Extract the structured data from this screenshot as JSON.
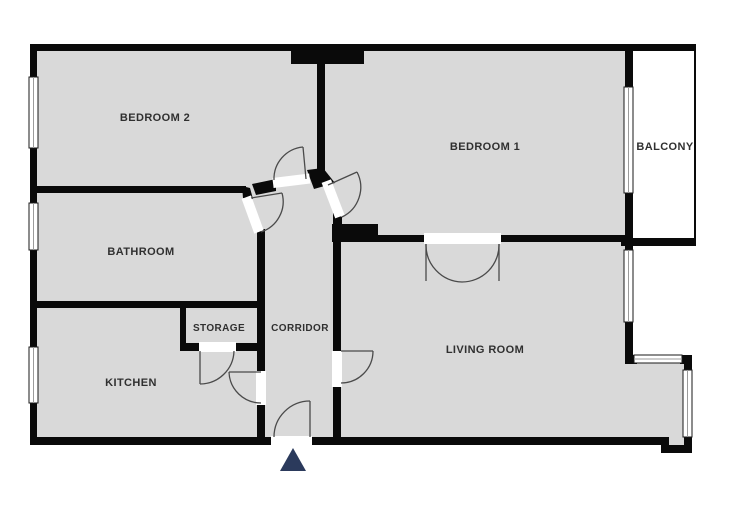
{
  "title": "Apartment floor plan",
  "rooms": [
    {
      "id": "bedroom-2",
      "label": "BEDROOM 2"
    },
    {
      "id": "bedroom-1",
      "label": "BEDROOM 1"
    },
    {
      "id": "balcony",
      "label": "BALCONY"
    },
    {
      "id": "bathroom",
      "label": "BATHROOM"
    },
    {
      "id": "storage",
      "label": "STORAGE"
    },
    {
      "id": "corridor",
      "label": "CORRIDOR"
    },
    {
      "id": "kitchen",
      "label": "KITCHEN"
    },
    {
      "id": "living-room",
      "label": "LIVING ROOM"
    }
  ],
  "colors": {
    "floor": "#d9d9d9",
    "wall": "#0a0a0a",
    "door_arc": "#4a4a4a",
    "entrance_arrow": "#2b3a5c",
    "window_fill": "#ffffff",
    "window_border": "#1a1a1a",
    "label_text": "#303030",
    "background": "#ffffff"
  },
  "entrance": {
    "marker": "entrance-arrow"
  }
}
